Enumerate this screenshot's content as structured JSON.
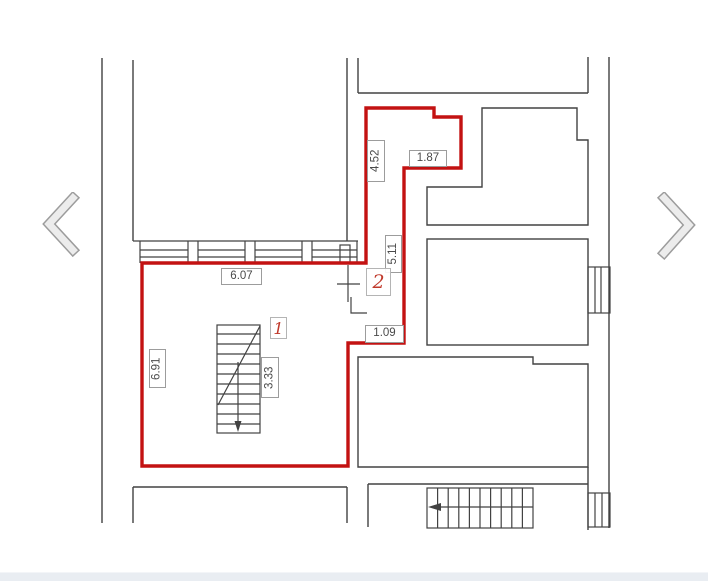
{
  "gallery": {
    "prev_icon": "chevron-left",
    "next_icon": "chevron-right"
  },
  "plan": {
    "type": "floor-plan",
    "outline_color": "#c31212",
    "wall_color": "#424242",
    "rooms": [
      {
        "number": "1"
      },
      {
        "number": "2"
      }
    ],
    "dimensions": {
      "room1_top_width": "6.07",
      "room1_left_height": "6.91",
      "room1_stairs_length": "3.33",
      "room2_left_height": "4.52",
      "room2_top_width": "1.87",
      "room2_length": "5.11",
      "room2_bottom_width": "1.09"
    }
  }
}
